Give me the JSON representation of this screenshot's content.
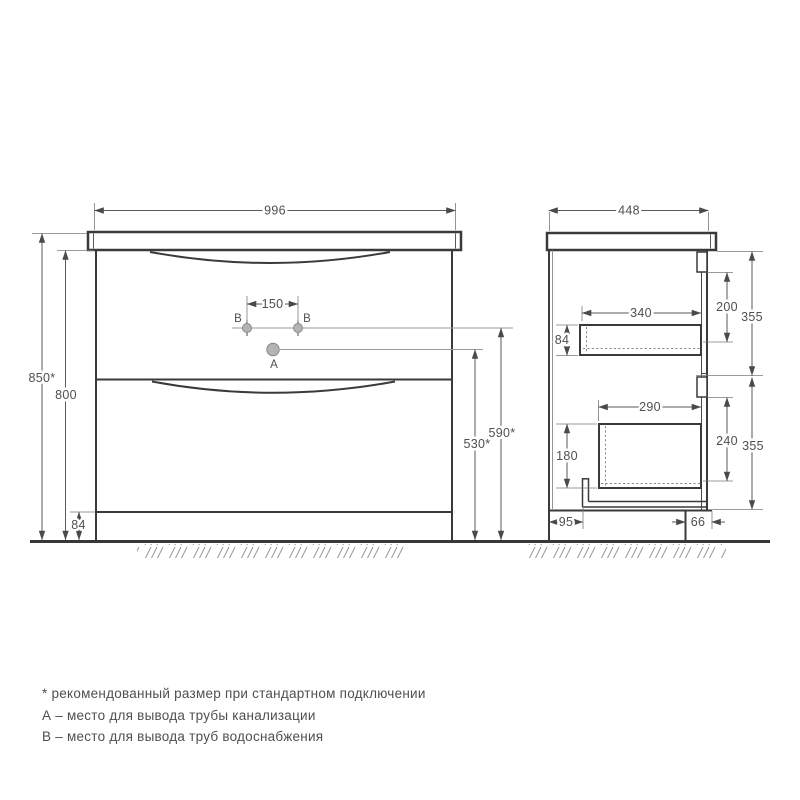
{
  "front": {
    "dim_width": "996",
    "dim_height_total": "850*",
    "dim_height_cabinet": "800",
    "dim_plinth_height": "84",
    "dim_holes_spacing": "150",
    "dim_drain_height": "530*",
    "dim_supply_height": "590*",
    "point_a_label": "А",
    "point_b_label": "В"
  },
  "side": {
    "dim_depth": "448",
    "dim_top_drawer_depth": "340",
    "dim_top_drawer_height": "84",
    "dim_top_clearance": "200",
    "dim_top_section_height": "355",
    "dim_bottom_drawer_depth": "290",
    "dim_bottom_drawer_height": "180",
    "dim_bottom_clearance": "240",
    "dim_bottom_section_height": "355",
    "dim_back_offset": "95",
    "dim_toe_kick_depth": "66"
  },
  "legend": {
    "note_recommended": "* рекомендованный размер при стандартном подключении",
    "note_a": "А – место для вывода трубы канализации",
    "note_b": "В – место для вывода труб водоснабжения"
  },
  "colors": {
    "line": "#3a3a3a",
    "dim_text": "#4f4f4f",
    "marker_fill": "#b4b4b4",
    "background": "#ffffff"
  }
}
